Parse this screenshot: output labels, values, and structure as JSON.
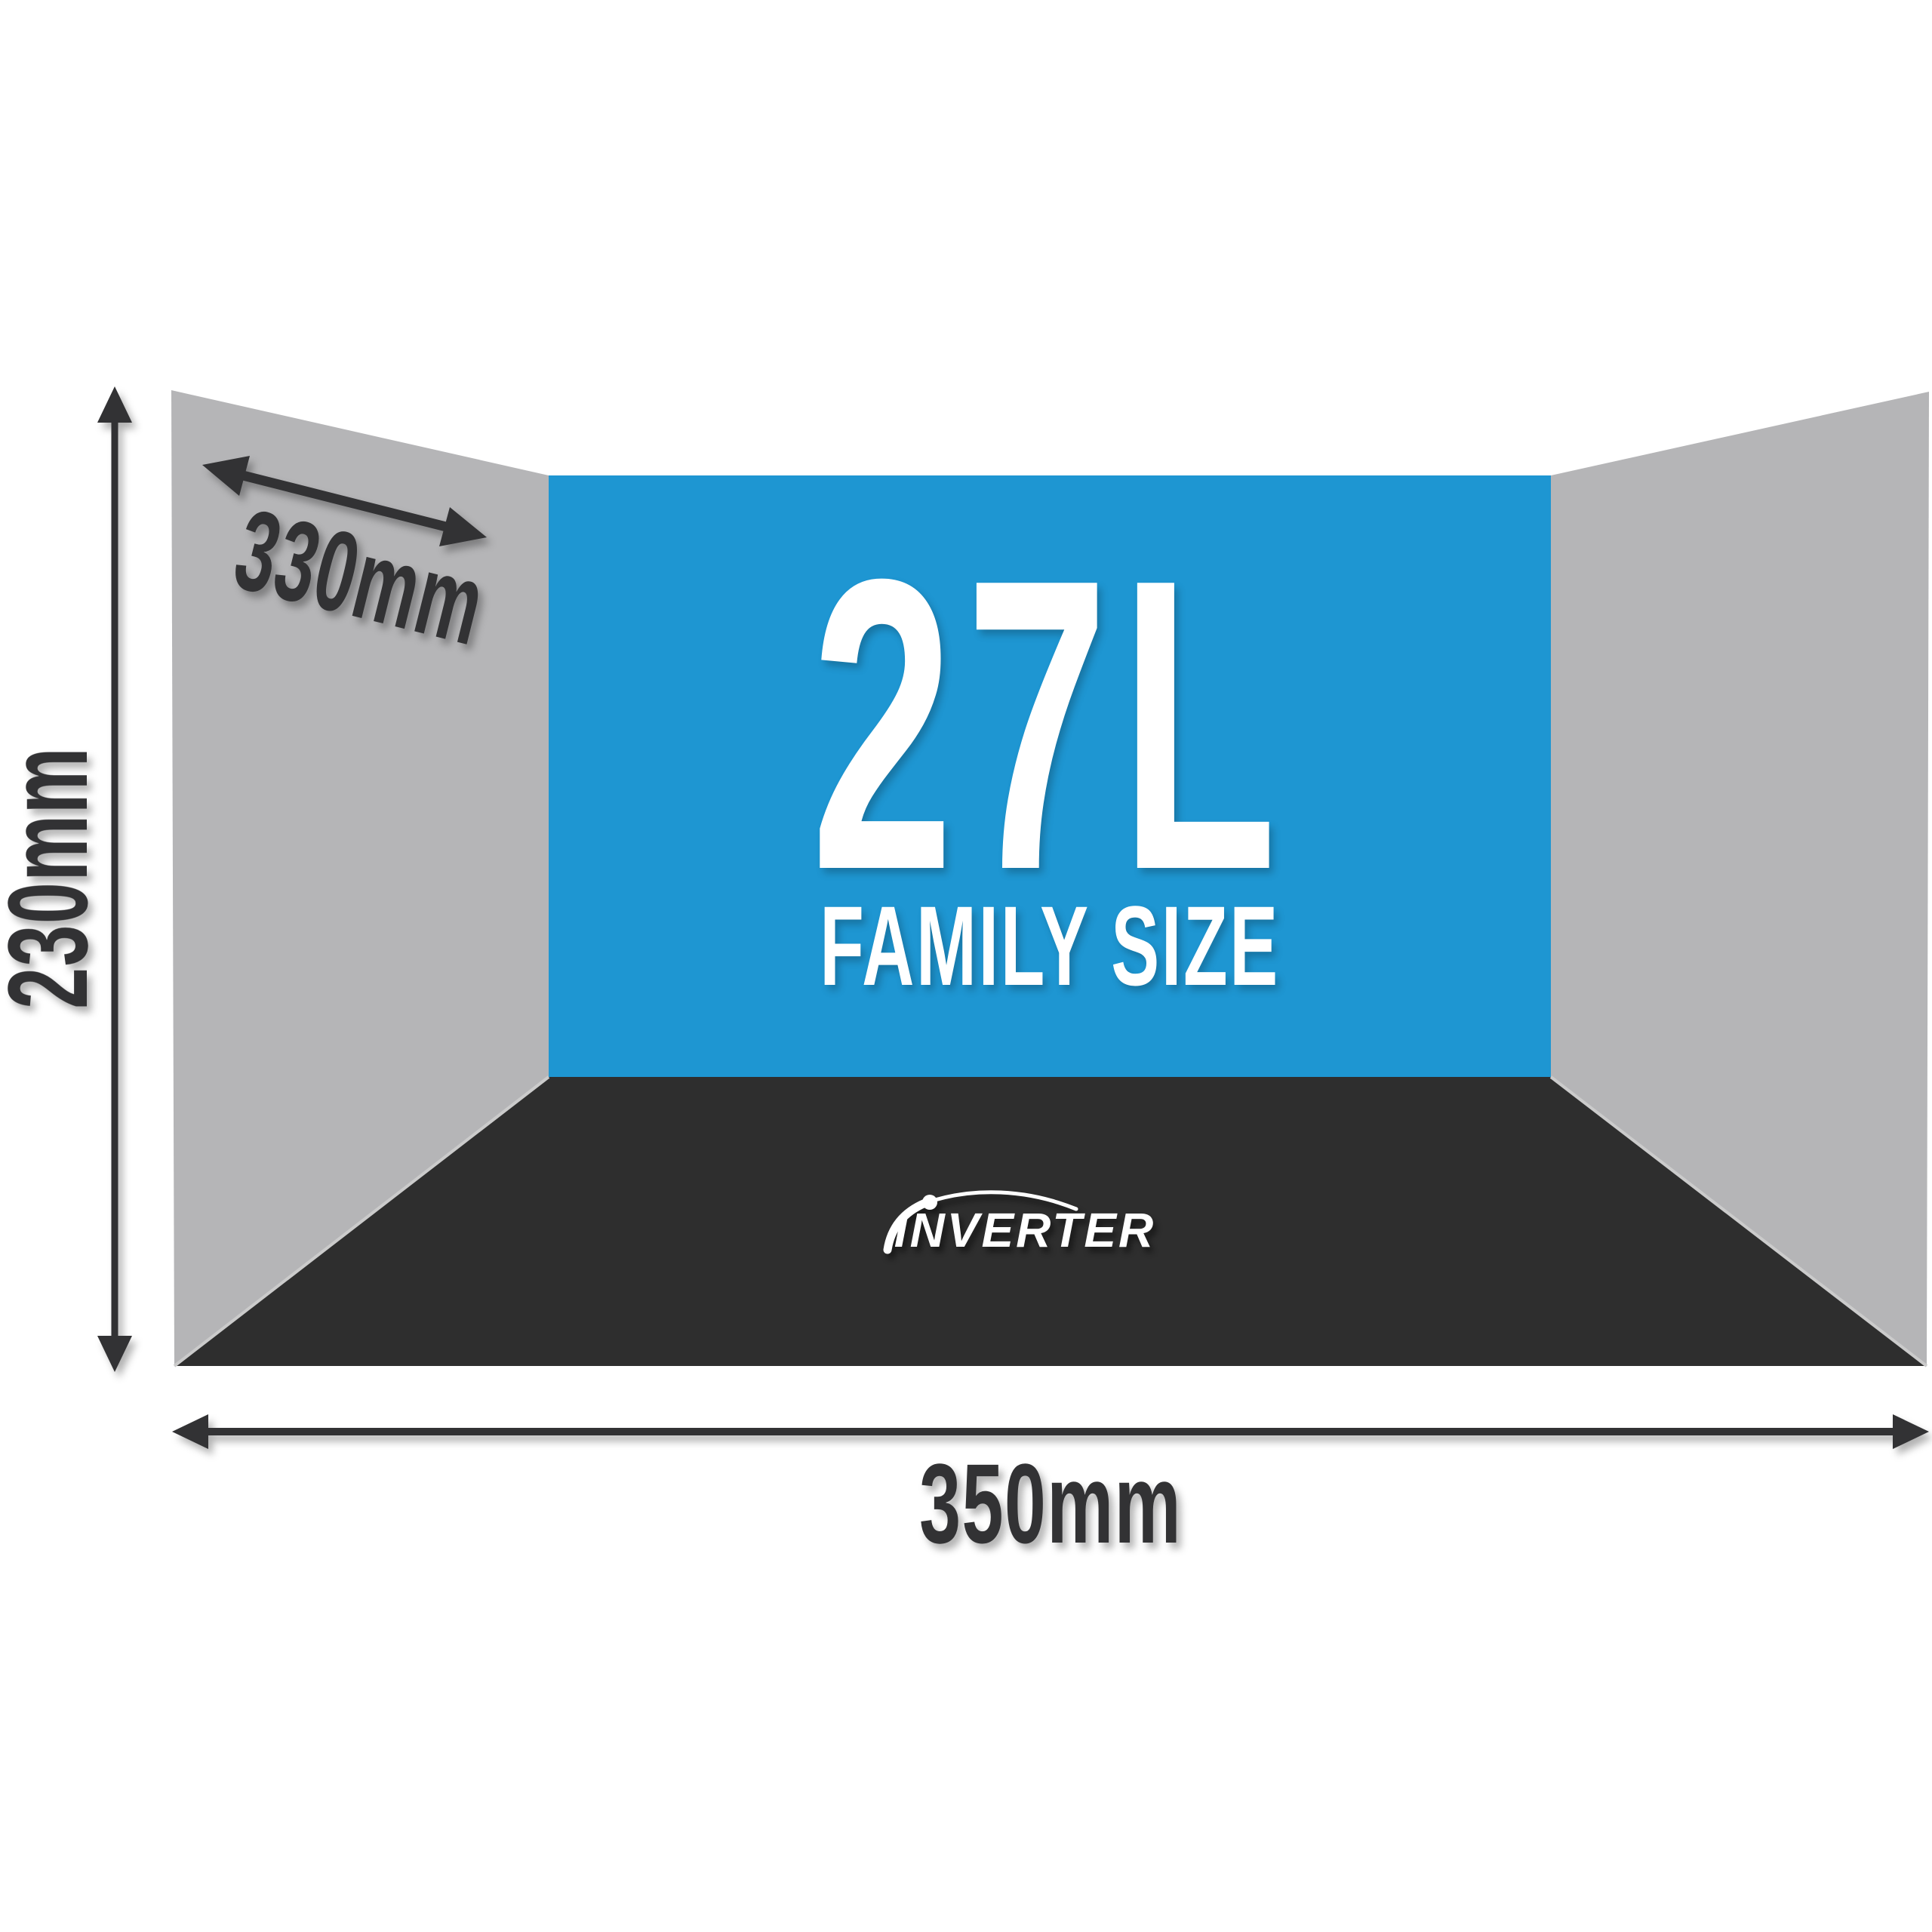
{
  "diagram_title": "Interior capacity diagram",
  "back_wall": {
    "capacity": "27L",
    "size_label": "FAMILY SIZE"
  },
  "floor": {
    "brand": "INVERTER"
  },
  "dimensions": {
    "height": "230mm",
    "depth": "330mm",
    "width": "350mm"
  },
  "colors": {
    "background": "#ffffff",
    "side_wall": "#b5b5b7",
    "back_wall": "#1e96d2",
    "floor": "#2e2e2e",
    "annotation": "#323234",
    "wall_text": "#ffffff",
    "brand_text": "#ffffff",
    "floor_edge_highlight": "#cbcbcb"
  }
}
